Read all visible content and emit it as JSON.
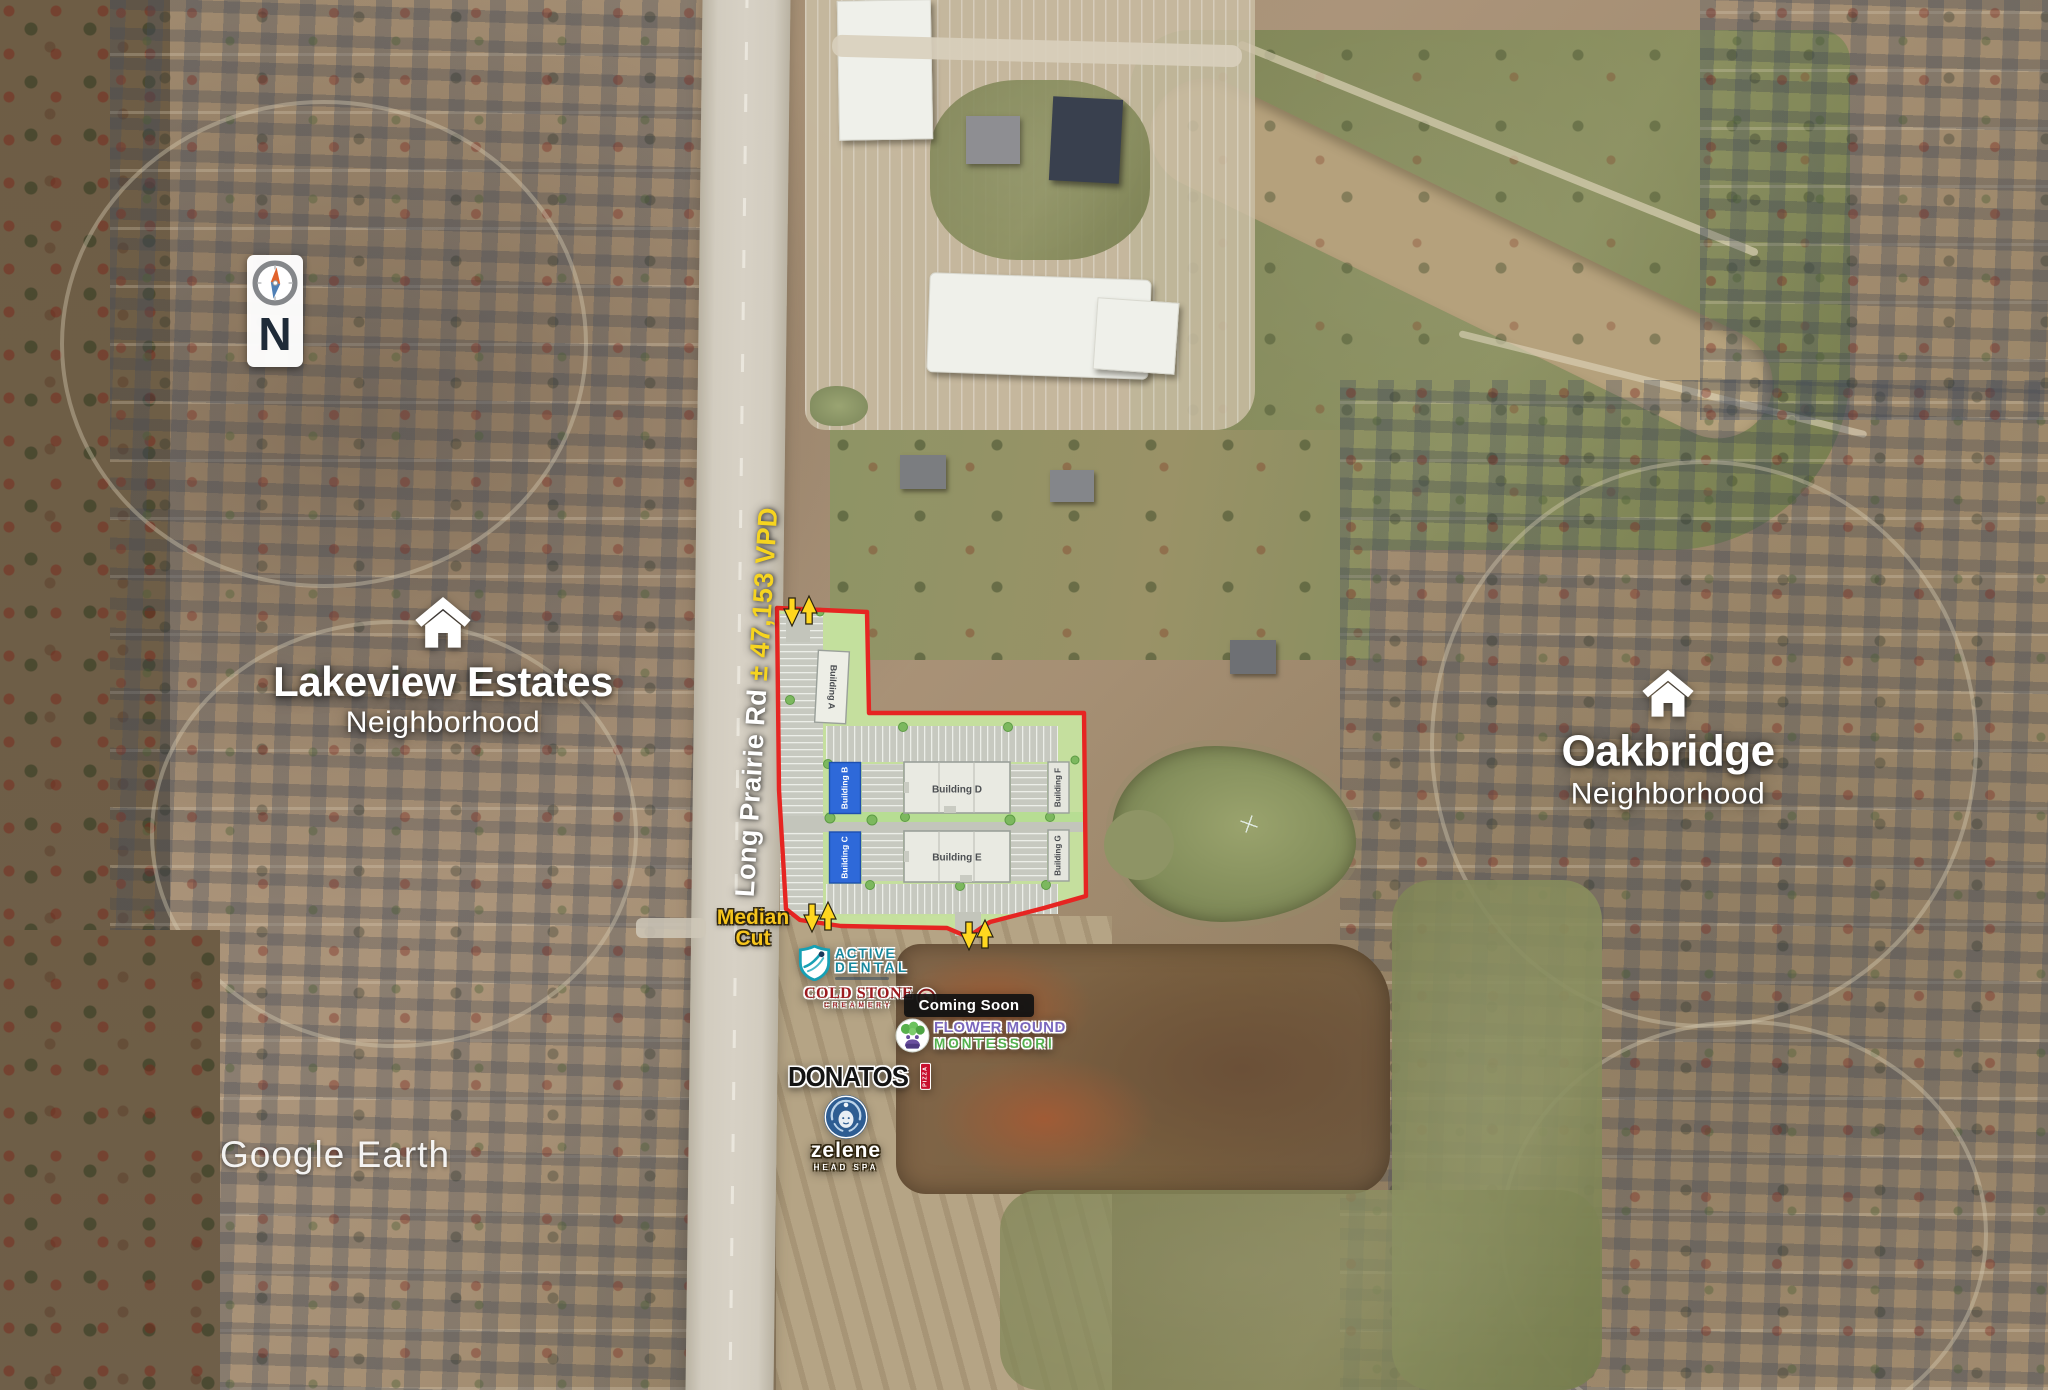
{
  "watermark": "Google Earth",
  "compass": {
    "letter": "N"
  },
  "road_label": {
    "name": "Long Prairie Rd ",
    "traffic": "± 47,153 VPD"
  },
  "median_cut": {
    "line1": "Median",
    "line2": "Cut"
  },
  "neighborhoods": {
    "lakeview": {
      "title": "Lakeview Estates",
      "subtitle": "Neighborhood"
    },
    "oakbridge": {
      "title": "Oakbridge",
      "subtitle": "Neighborhood"
    }
  },
  "site_plan": {
    "buildings": [
      {
        "label": "Building A"
      },
      {
        "label": "Building B"
      },
      {
        "label": "Building C"
      },
      {
        "label": "Building D"
      },
      {
        "label": "Building E"
      },
      {
        "label": "Building F"
      },
      {
        "label": "Building G"
      }
    ]
  },
  "tenants": {
    "active_dental": {
      "line1": "ACTIVE",
      "line2": "DENTAL"
    },
    "cold_stone": {
      "line1": "COLD STONE",
      "line2": "CREAMERY"
    },
    "coming_soon": {
      "label": "Coming Soon"
    },
    "montessori": {
      "line1": "FLOWER MOUND",
      "line2": "MONTESSORI"
    },
    "donatos": {
      "name": "DONATOS",
      "tag": "PIZZA"
    },
    "zelene": {
      "name": "zelene",
      "sub": "HEAD SPA"
    }
  },
  "colors": {
    "boundary_red": "#e62522",
    "arrow_yellow": "#ffd71f",
    "building_blue": "#2e69d9",
    "site_green": "#c8e6a2",
    "traffic_yellow": "#f6d41f",
    "median_yellow": "#f6c51d"
  }
}
